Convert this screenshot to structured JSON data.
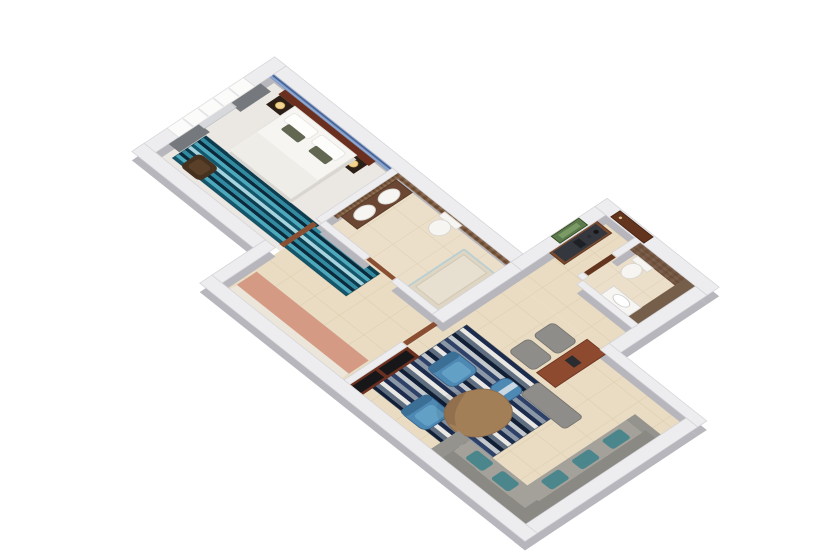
{
  "scene": {
    "type": "3d-floor-plan-render",
    "description": "Isometric 3D rendered floor plan of a one-bedroom suite",
    "background": "#ffffff"
  },
  "colors": {
    "wall_top": "#ededf0",
    "wall_shadow": "#b6b6bc",
    "wall_edge": "#d2d2d6",
    "floor_beige": "#e9dcc2",
    "floor_bath": "#ecdfca",
    "carpet": "#ebe7e2",
    "door": "#8a4f33",
    "door_dark": "#63341e",
    "headboard": "#6a2f1e",
    "bed_white": "#f6f5f2",
    "bed_shadow": "#d9d6d1",
    "pillow_olive": "#626751",
    "sofa_dark": "#8b8984",
    "sofa_light": "#a3a19a",
    "pillow_teal": "#4a868c",
    "chair_blue": "#4e89b4",
    "chair_blue_dark": "#3c6f96",
    "table_wood": "#a37f58",
    "table_wood_dark": "#8a6a4a",
    "console_wood": "#7b4a2e",
    "console_top": "#34373d",
    "art_green": "#5d7a4c",
    "vanity_brown": "#6b4733",
    "fixture_white": "#f6f5f2",
    "salmon": "#d49a84",
    "tile_wall_brown": "#6b5342",
    "curtain": "#75787c",
    "screen_dark": "#17171a",
    "gray_chair": "#8f8d89",
    "accent_band_blue": "#7492c2",
    "glass_blue": "#a8cbd8",
    "lamp_glow": "#f2d492",
    "threshold": "#cdbca2",
    "wood_chair_dark": "#46311f",
    "shelf_white": "#ece6da"
  },
  "rugs": {
    "bedroom": {
      "name": "bedroom-rug-stripe",
      "x": 16,
      "y": 104,
      "width": 242,
      "height": 44,
      "band": 4,
      "colors": [
        "#0b3c50",
        "#2f8ba1",
        "#082a3c",
        "#4aa9bd",
        "#12566c",
        "#a6d4de"
      ]
    },
    "living": {
      "name": "living-rug-stripe",
      "x": 362,
      "y": 88,
      "width": 143,
      "height": 124,
      "band": 5,
      "colors": [
        "#1c2c4e",
        "#e9e8e4",
        "#5e6e80",
        "#101e36",
        "#c3c8cd",
        "#2e4168",
        "#8a97a6"
      ]
    }
  },
  "rooms": [
    {
      "name": "bedroom",
      "items": [
        "double-bed",
        "white-pillows",
        "olive-accent-pillows",
        "headboard-panel",
        "blue-stripe-wallpaper-band",
        "nightstand-left",
        "nightstand-right",
        "table-lamps",
        "teal-striped-runner-rug",
        "curtains",
        "sheer-curtain",
        "window",
        "dark-wood-armchair"
      ]
    },
    {
      "name": "main-bathroom",
      "items": [
        "mosaic-tile-wall",
        "double-sink-vanity",
        "wall-hung-toilet",
        "walk-in-shower",
        "glass-shower-screen",
        "bathroom-door"
      ]
    },
    {
      "name": "dressing-corridor",
      "items": [
        "terracotta-closet-strip",
        "closet-shelf",
        "bedroom-door",
        "corridor-door"
      ]
    },
    {
      "name": "entry-hall",
      "items": [
        "entry-door",
        "door-threshold",
        "minibar-console",
        "coffee-service-items",
        "botanical-wall-art"
      ]
    },
    {
      "name": "guest-bathroom",
      "items": [
        "tile-accent-wall",
        "wall-hung-toilet",
        "vanity-sink",
        "guest-bathroom-door"
      ]
    },
    {
      "name": "living-room",
      "items": [
        "navy-striped-area-rug",
        "blue-armchair",
        "blue-armchair",
        "blue-ottoman",
        "pebble-coffee-table",
        "sectional-sofa",
        "teal-patterned-pillows",
        "tv-media-console",
        "wood-desk",
        "desk-chair",
        "desk-chair",
        "gray-bench"
      ]
    }
  ]
}
